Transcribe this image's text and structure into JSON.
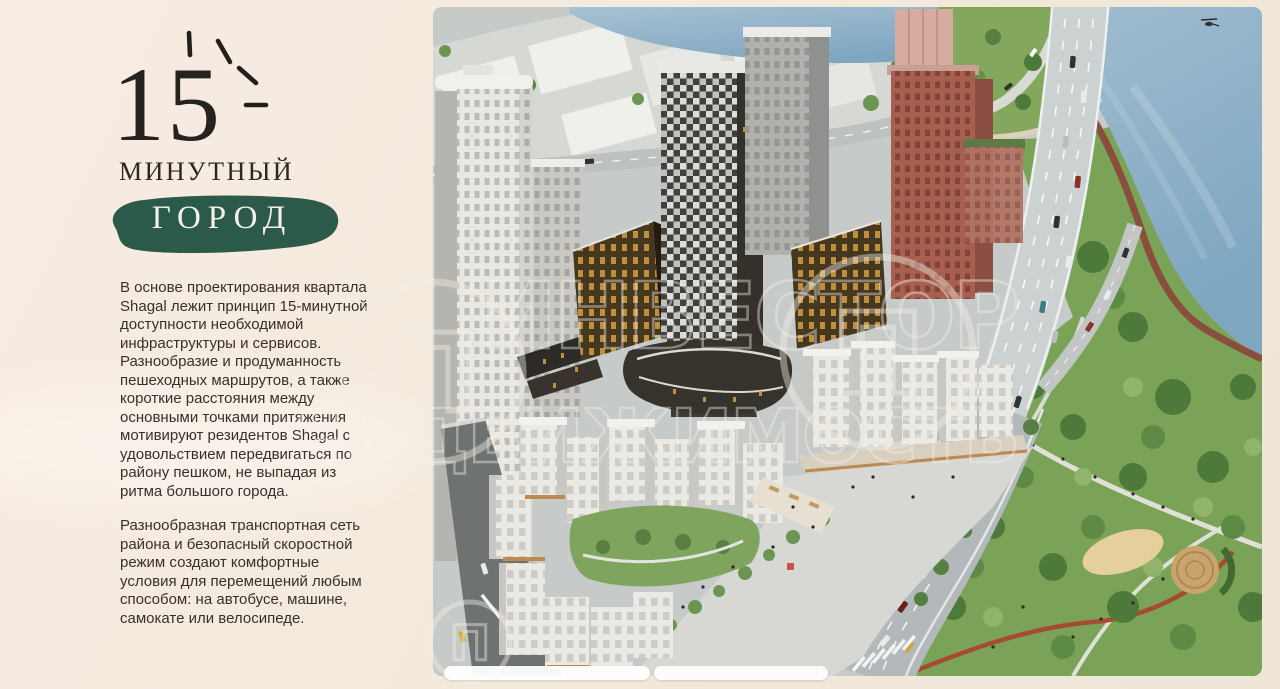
{
  "left_panel": {
    "headline": {
      "number": "15",
      "line1": "МИНУТНЫЙ",
      "line2": "ГОРОД"
    },
    "paragraphs": [
      "В основе проектирования квартала Shagal лежит принцип 15-минутной доступности необходимой инфраструктуры и сервисов. Разнообразие и продуманность пешеходных маршрутов, а также короткие расстояния между основными точками притяжения мотивируют резидентов Shagal с удовольствием передвигаться по району пешком, не выпадая из ритма большого города.",
      "Разнообразная транспортная сеть района и безопасный скоростной режим создают комфортные условия для перемещений любым способом: на автобусе, машине, самокате или велосипеде."
    ]
  },
  "hero_image": {
    "description": "Аэровид квартала Shagal: жилые башни у реки, мост, бульвар и парк с набережной",
    "watermark": {
      "emblem_letter": "П",
      "line1": "ИНВЕСТОР",
      "line2": "НЕДВИЖИМОСТЬ"
    }
  },
  "colors": {
    "background_beige": "#f3e9db",
    "accent_green": "#2b5a4b",
    "title_text": "#26231f",
    "body_text": "#34312c",
    "water": "#7ea6c1",
    "park_green": "#7aa357",
    "brick_tower": "#a7604f",
    "road_gray": "#b3b9ba"
  }
}
